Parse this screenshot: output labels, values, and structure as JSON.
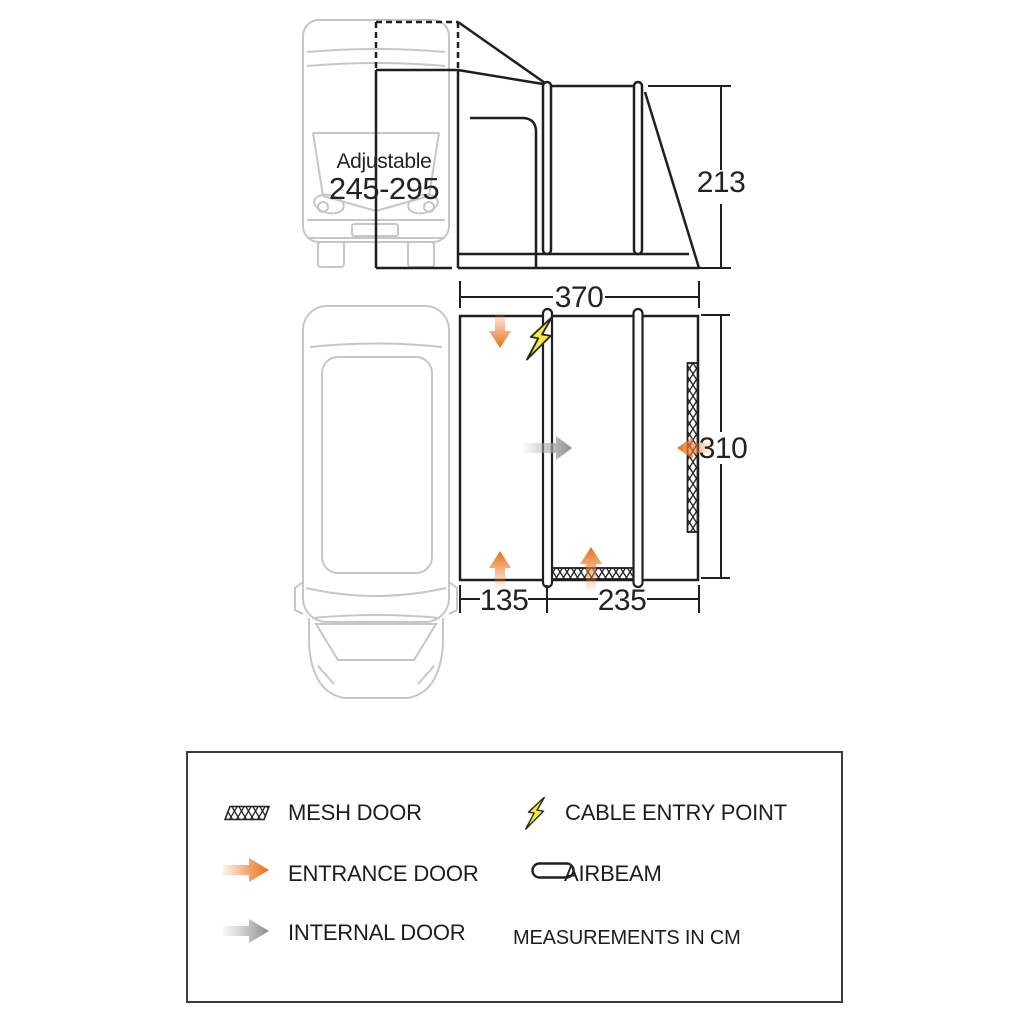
{
  "diagram": {
    "type": "awning-dimension-diagram",
    "views": {
      "side": {
        "height_cm": "213",
        "width_cm": "370",
        "van_adjustable_label": "Adjustable",
        "van_adjustable_range": "245-295"
      },
      "plan": {
        "depth_cm": "310",
        "front_room_cm": "135",
        "main_room_cm": "235"
      }
    }
  },
  "legend": {
    "items": [
      {
        "id": "mesh-door",
        "label": "MESH DOOR"
      },
      {
        "id": "entrance-door",
        "label": "ENTRANCE DOOR"
      },
      {
        "id": "internal-door",
        "label": "INTERNAL DOOR"
      },
      {
        "id": "cable-entry-point",
        "label": "CABLE ENTRY POINT"
      },
      {
        "id": "airbeam",
        "label": "AIRBEAM"
      }
    ],
    "note": "MEASUREMENTS IN CM"
  },
  "colors": {
    "accent_orange": "#ED7B2E",
    "accent_yellow": "#F5ED3E",
    "internal_gray": "#8F8F8F",
    "line": "#1F1F1F",
    "van_outline": "#C6C6C6"
  }
}
